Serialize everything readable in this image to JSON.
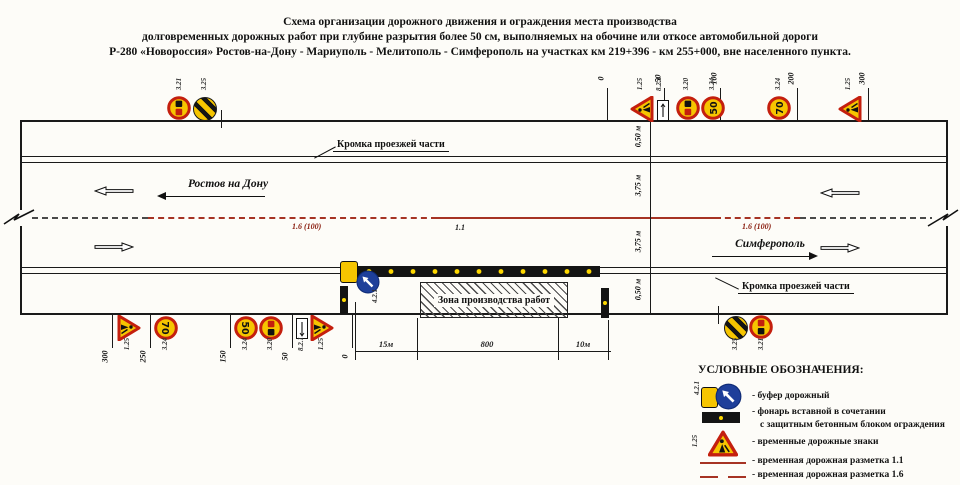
{
  "title": {
    "line1": "Схема организации дорожного движения и ограждения места производства",
    "line2": "долговременных дорожных работ при глубине разрытия более 50 см,  выполняемых на обочине или откосе автомобильной дороги",
    "line3": "Р-280 «Новороссия»  Ростов-на-Дону - Мариуполь - Мелитополь - Симферополь на участках км 219+396 - км 255+000, вне населенного пункта."
  },
  "road": {
    "edge_label_top": "Кромка проезжей части",
    "edge_label_bottom": "Кромка проезжей части",
    "dir_top_label": "Ростов на Дону",
    "dir_bottom_label": "Симферополь",
    "marking_label_left": "1.6 (100)",
    "marking_label_center": "1.1",
    "marking_label_right": "1.6 (100)",
    "dims": {
      "d1": "0,50 м",
      "d2": "3,75 м",
      "d3": "3,75 м",
      "d4": "0,50 м"
    },
    "scale_top": [
      "0",
      "50",
      "100",
      "200",
      "300"
    ],
    "scale_bottom": [
      "300",
      "250",
      "150",
      "50",
      "0"
    ],
    "workzone": {
      "label": "Зона производства работ",
      "dim_left": "15м",
      "dim_mid": "800",
      "dim_right": "10м"
    }
  },
  "signs": {
    "buffer_code": "4.2.1",
    "top_left": [
      {
        "code": "3.21"
      },
      {
        "code": "3.25"
      }
    ],
    "top_right": [
      {
        "code": "1.25"
      },
      {
        "code": "8.2.1"
      },
      {
        "code": "3.20"
      },
      {
        "code": "3.24",
        "value": "50"
      },
      {
        "code": "3.24",
        "value": "70"
      },
      {
        "code": "1.25"
      }
    ],
    "bottom_left": [
      {
        "code": "1.25"
      },
      {
        "code": "3.24",
        "value": "70"
      },
      {
        "code": "3.24",
        "value": "50"
      },
      {
        "code": "3.20"
      },
      {
        "code": "8.2.1"
      },
      {
        "code": "1.25"
      }
    ],
    "bottom_right": [
      {
        "code": "3.25"
      },
      {
        "code": "3.21"
      }
    ]
  },
  "legend": {
    "title": "УСЛОВНЫЕ ОБОЗНАЧЕНИЯ:",
    "sign_code": "1.25",
    "buffer_code": "4.2.1",
    "items": {
      "buffer": "- буфер дорожный",
      "lantern1": "- фонарь вставной  в сочетании",
      "lantern2": "с защитным бетонным блоком ограждения",
      "signs": "- временные дорожные знаки",
      "marking11": "- временная дорожная разметка 1.1",
      "marking16": "- временная дорожная разметка 1.6"
    }
  },
  "colors": {
    "marking_red": "#a63324",
    "sign_yellow": "#f6c500",
    "sign_rim_red": "#c41f0e",
    "sign_blue": "#1e3f9a",
    "lantern_dot_yellow": "#ffd900"
  }
}
